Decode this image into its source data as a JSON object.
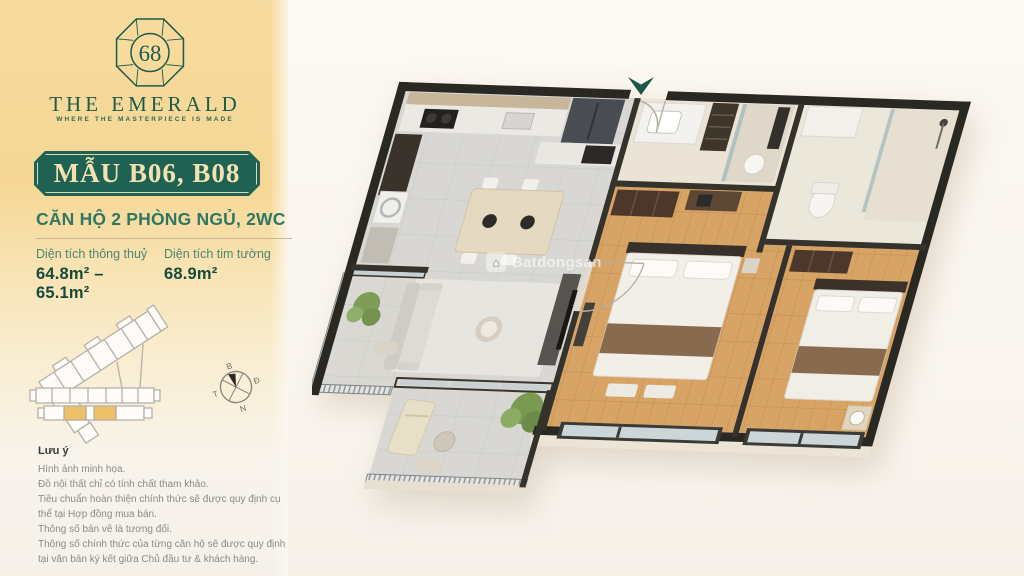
{
  "brand": {
    "logo_number": "68",
    "name": "THE EMERALD",
    "tagline": "WHERE THE MASTERPIECE IS MADE"
  },
  "unit": {
    "model_label": "MẪU B06, B08",
    "type_heading": "CĂN HỘ 2 PHÒNG NGỦ, 2WC",
    "areas": [
      {
        "label": "Diện tích thông thuỷ",
        "value": "64.8m² – 65.1m²"
      },
      {
        "label": "Diện tích tim tường",
        "value": "68.9m²"
      }
    ]
  },
  "compass": {
    "north": "B",
    "east": "Đ",
    "south": "N",
    "west": "T"
  },
  "notes": {
    "title": "Lưu ý",
    "lines": [
      "Hình ảnh minh họa.",
      "Đồ nội thất chỉ có tính chất tham khảo.",
      "Tiêu chuẩn hoàn thiện chính thức sẽ được quy định cụ thể tại Hợp đồng mua bán.",
      "Thông số bản vẽ là tương đối.",
      "Thông số chính thức của từng căn hộ sẽ được quy định tại văn bản ký kết giữa Chủ đầu tư & khách hàng."
    ]
  },
  "watermark": {
    "text": "Batdongsan"
  },
  "colors": {
    "panel-gold": "#f7db9e",
    "brand-green": "#1d5c4c",
    "badge-green": "#1f6153",
    "badge-text": "#f3e2b0",
    "heading-green": "#2e7763",
    "label-green": "#4b8671",
    "value-green": "#17493d",
    "divider-gold": "#c9ba90",
    "highlight-gold": "#eec168",
    "note-gray": "#8b8a85",
    "arrow-green": "#1a574a",
    "wall-dark": "#2a2823"
  }
}
